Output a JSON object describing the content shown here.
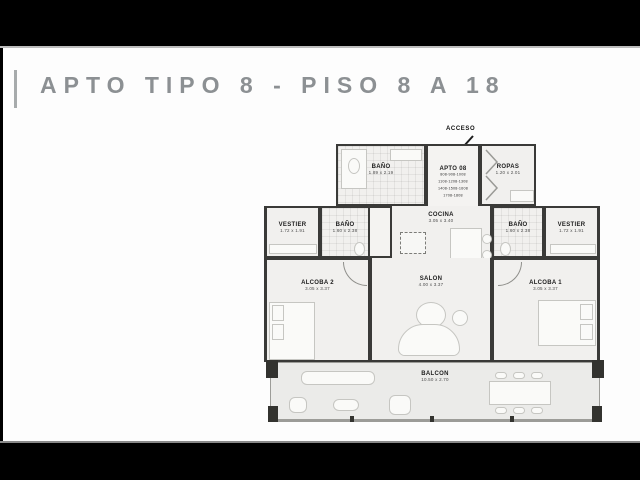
{
  "slide": {
    "title": "APTO TIPO 8 - PISO 8 A 18",
    "accent_color": "#8c9093",
    "wall_color": "#3a3a38",
    "floor_color": "#f1f0ee"
  },
  "plan": {
    "acceso_label": "ACCESO",
    "rooms": {
      "bano_top": {
        "name": "BAÑO",
        "dim": "1.89 x 2.19"
      },
      "apto": {
        "name": "APTO 08",
        "units": [
          "808-908-1008",
          "1108-1208-1308",
          "1408-1508-1608",
          "1708-1808"
        ]
      },
      "ropas": {
        "name": "ROPAS",
        "dim": "1.20 x 2.01"
      },
      "cocina": {
        "name": "COCINA",
        "dim": "3.05 x 3.40"
      },
      "vestier_left": {
        "name": "VESTIER",
        "dim": "1.72 x 1.91"
      },
      "bano_left": {
        "name": "BAÑO",
        "dim": "1.60 x 2.38"
      },
      "bano_right": {
        "name": "BAÑO",
        "dim": "1.60 x 2.38"
      },
      "vestier_right": {
        "name": "VESTIER",
        "dim": "1.72 x 1.91"
      },
      "alcoba2": {
        "name": "ALCOBA 2",
        "dim": "3.05 x 3.37"
      },
      "salon": {
        "name": "SALON",
        "dim": "4.00 x 3.37"
      },
      "alcoba1": {
        "name": "ALCOBA 1",
        "dim": "3.05 x 3.37"
      },
      "balcon": {
        "name": "BALCON",
        "dim": "10.50 x 2.70"
      }
    }
  }
}
